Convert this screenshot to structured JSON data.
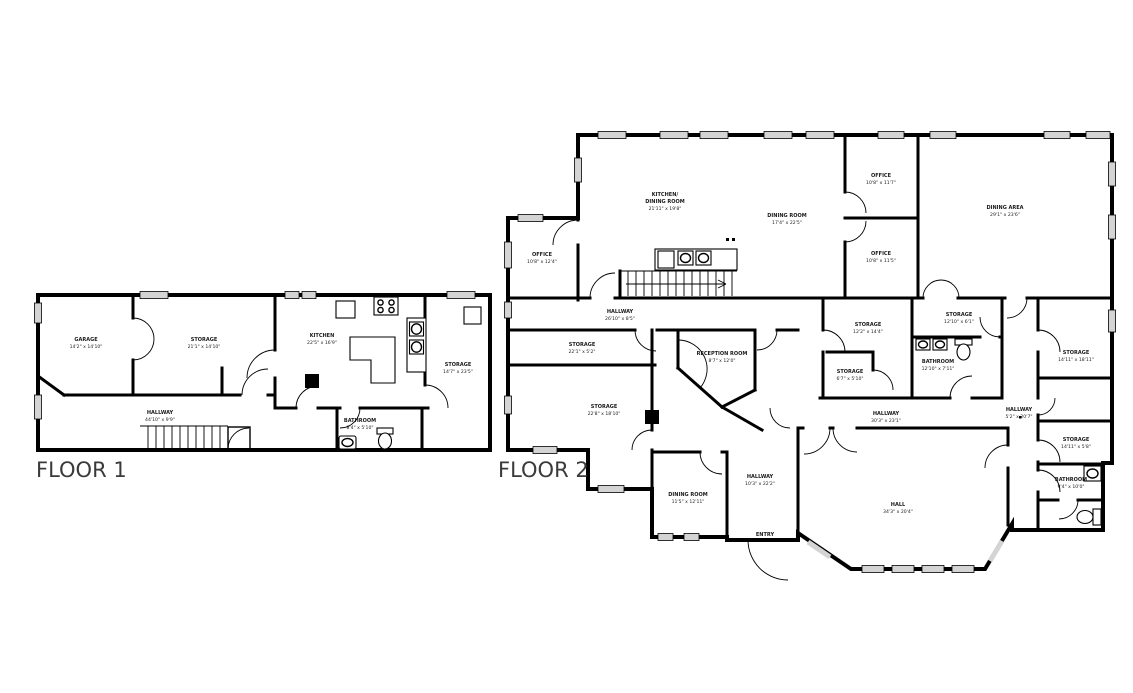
{
  "colors": {
    "wall": "#000000",
    "window_fill": "#d4d4d4",
    "room_text": "#1a1a1a",
    "floor_label_text": "#3a3a3a",
    "background": "#ffffff"
  },
  "floor1": {
    "label": "FLOOR 1",
    "rooms": [
      {
        "name": "GARAGE",
        "dims": "14'2\" x 14'10\""
      },
      {
        "name": "STORAGE",
        "dims": "21'1\" x 14'10\""
      },
      {
        "name": "KITCHEN",
        "dims": "22'5\" x 16'9\""
      },
      {
        "name": "STORAGE",
        "dims": "14'7\" x 23'5\""
      },
      {
        "name": "HALLWAY",
        "dims": "44'10\" x 9'9\""
      },
      {
        "name": "BATHROOM",
        "dims": "8'4\" x 5'10\""
      }
    ]
  },
  "floor2": {
    "label": "FLOOR 2",
    "rooms": [
      {
        "name": "KITCHEN/",
        "name2": "DINING ROOM",
        "dims": "21'11\" x 19'8\""
      },
      {
        "name": "DINING ROOM",
        "dims": "17'4\" x 22'5\""
      },
      {
        "name": "OFFICE",
        "dims": "10'8\" x 11'7\""
      },
      {
        "name": "OFFICE",
        "dims": "10'8\" x 11'5\""
      },
      {
        "name": "DINING AREA",
        "dims": "29'1\" x 23'6\""
      },
      {
        "name": "OFFICE",
        "dims": "10'8\" x 12'4\""
      },
      {
        "name": "HALLWAY",
        "dims": "26'10\" x 8'5\""
      },
      {
        "name": "STORAGE",
        "dims": "22'1\" x 5'2\""
      },
      {
        "name": "STORAGE",
        "dims": "22'8\" x 18'10\""
      },
      {
        "name": "RECEPTION ROOM",
        "dims": "8'7\" x 12'0\""
      },
      {
        "name": "STORAGE",
        "dims": "12'2\" x 14'4\""
      },
      {
        "name": "STORAGE",
        "dims": "12'10\" x 6'1\""
      },
      {
        "name": "STORAGE",
        "dims": "6'7\" x 5'10\""
      },
      {
        "name": "BATHROOM",
        "dims": "12'10\" x 7'11\""
      },
      {
        "name": "STORAGE",
        "dims": "14'11\" x 18'11\""
      },
      {
        "name": "HALLWAY",
        "dims": "5'2\" x 20'7\""
      },
      {
        "name": "STORAGE",
        "dims": "14'11\" x 5'8\""
      },
      {
        "name": "BATHROOM",
        "dims": "9'4\" x 10'0\""
      },
      {
        "name": "HALLWAY",
        "dims": "30'3\" x 23'1\""
      },
      {
        "name": "DINING ROOM",
        "dims": "11'5\" x 12'11\""
      },
      {
        "name": "HALLWAY",
        "dims": "10'3\" x 22'2\""
      },
      {
        "name": "ENTRY",
        "dims": ""
      },
      {
        "name": "HALL",
        "dims": "34'3\" x 20'4\""
      }
    ]
  }
}
